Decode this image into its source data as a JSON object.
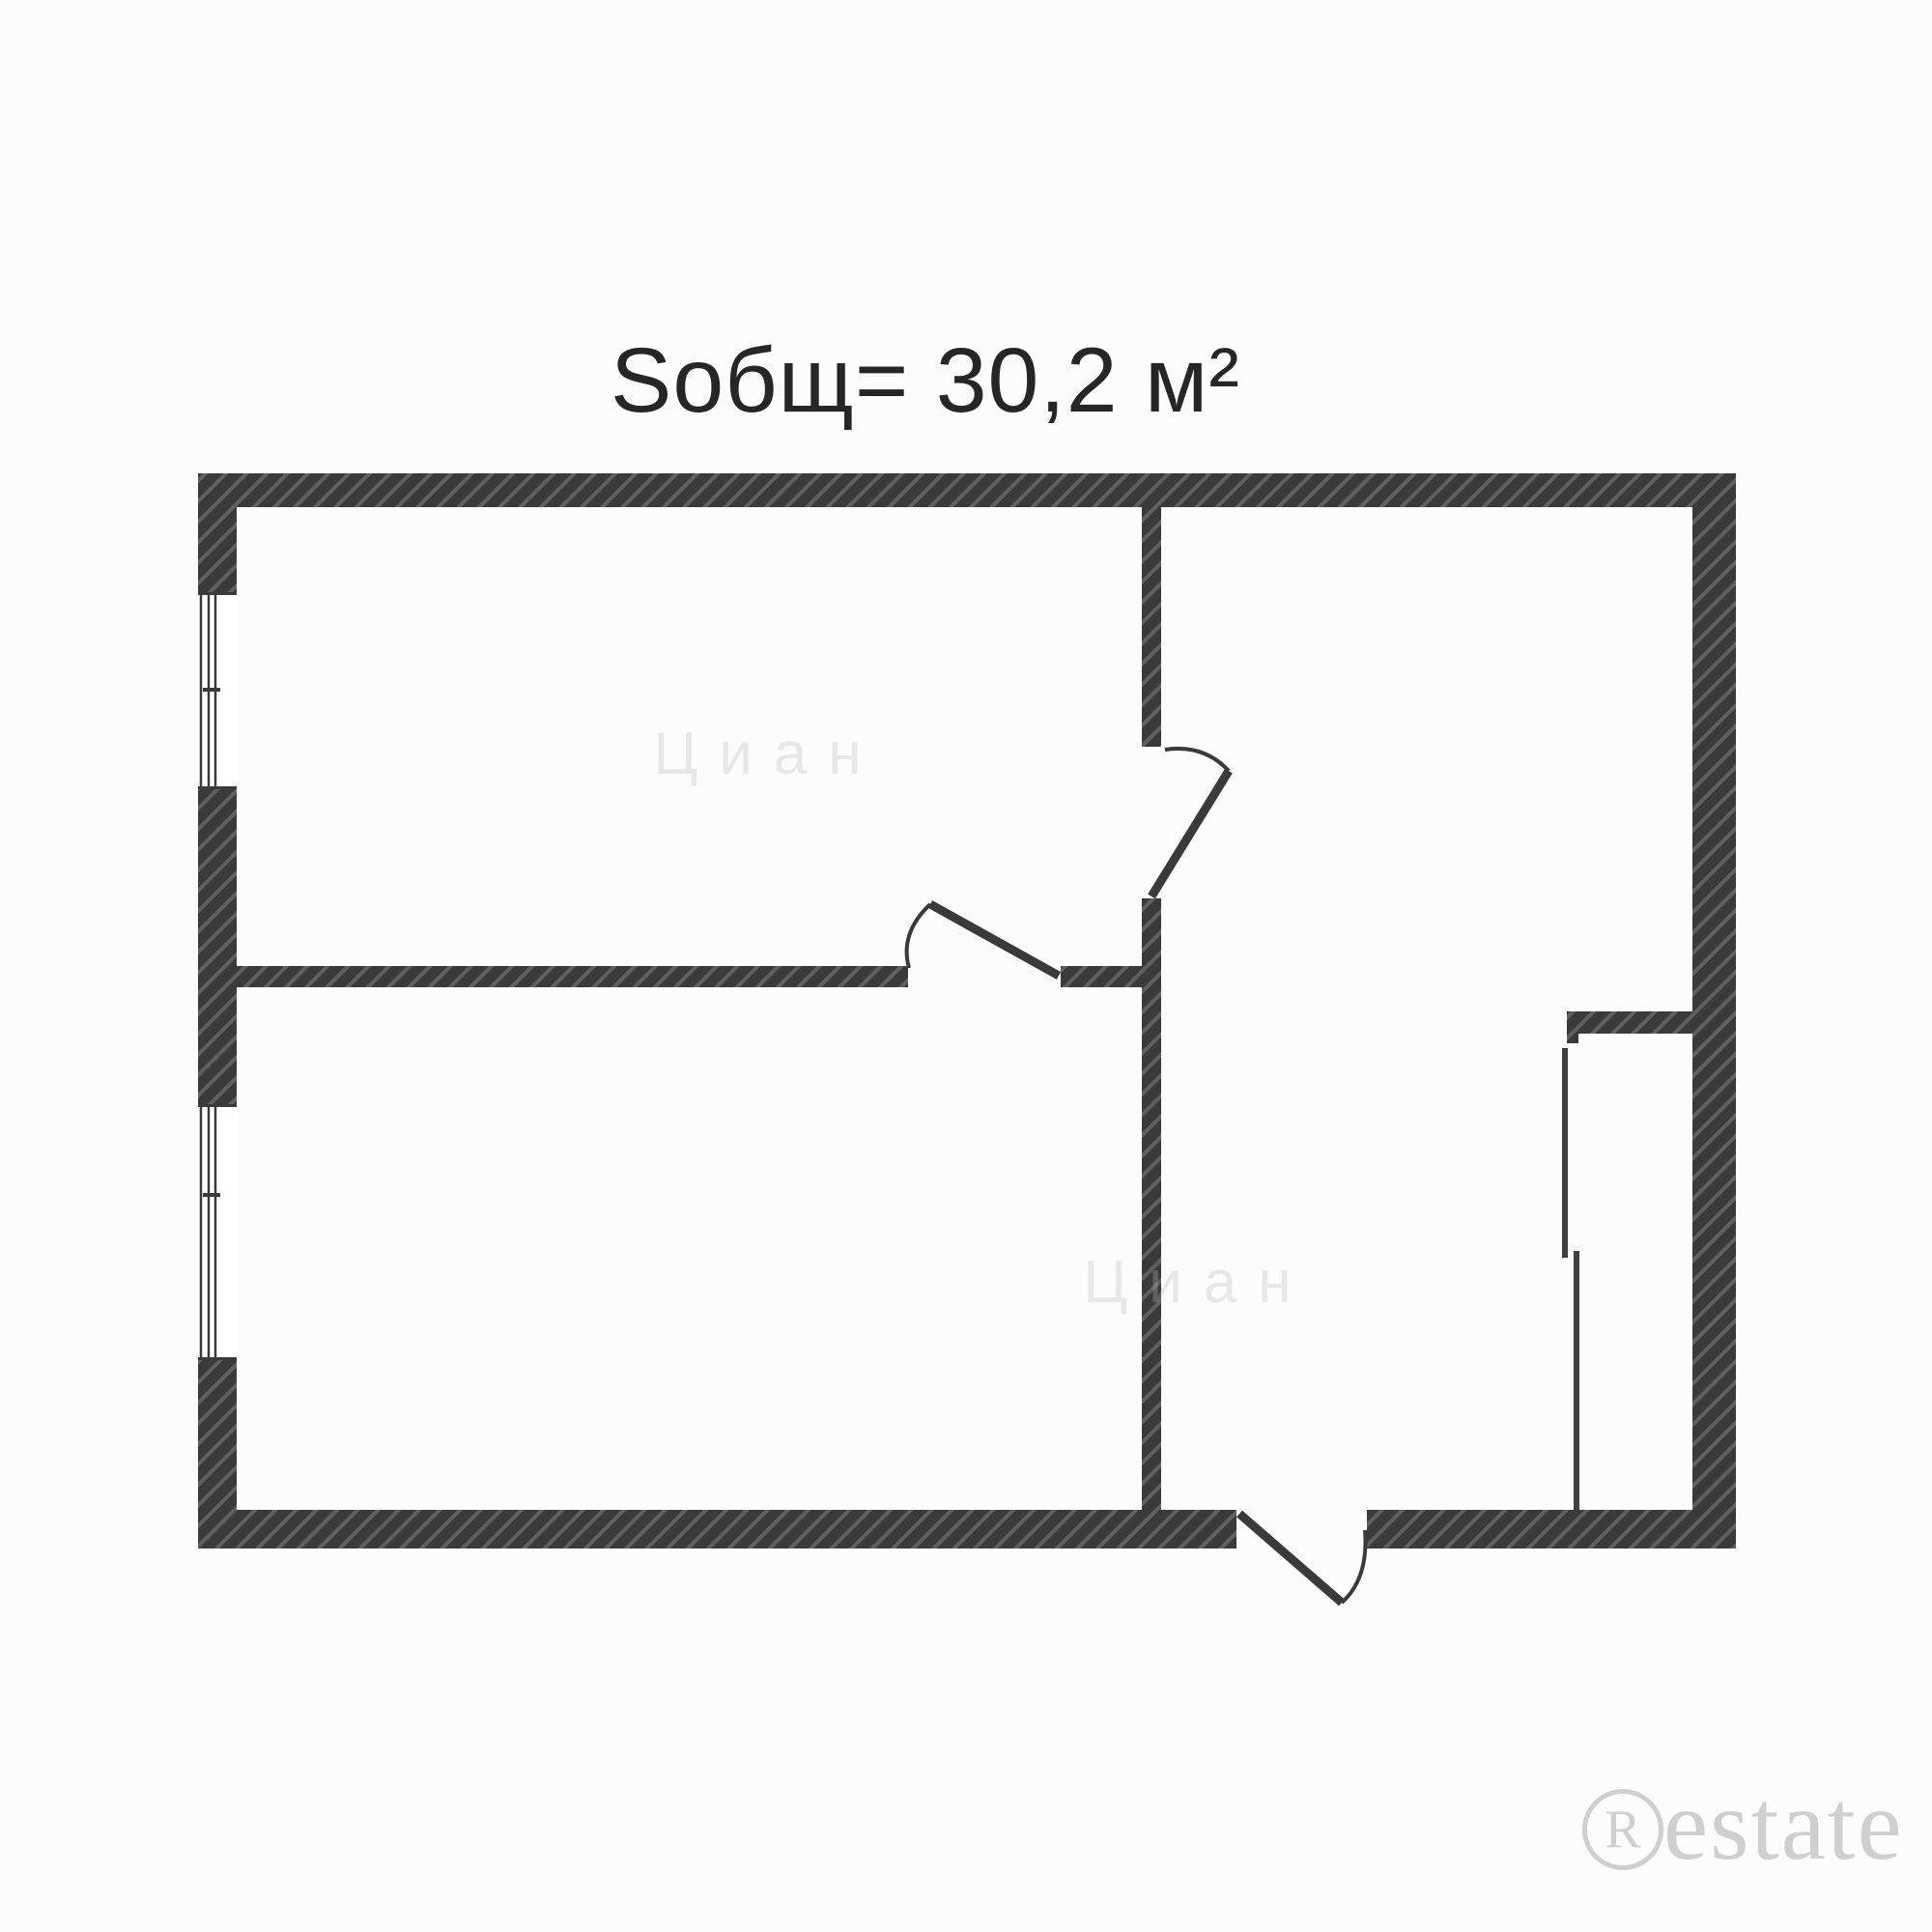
{
  "title": {
    "text": "Sобщ= 30,2 м²"
  },
  "plan": {
    "total_area_label": "Sобщ",
    "total_area_value": "30,2",
    "total_area_unit": "м²",
    "colors": {
      "wall_dark": "#3a3a3a",
      "wall_hatch_light": "#606060",
      "background": "#fcfcfc",
      "interior_white": "#ffffff"
    },
    "elements": {
      "windows": [
        {
          "name": "upper-left-window",
          "wall": "left"
        },
        {
          "name": "lower-left-window",
          "wall": "left"
        }
      ],
      "doors": [
        {
          "name": "interior-door-between-rooms",
          "wall": "horizontal-partition"
        },
        {
          "name": "interior-door-hallway",
          "wall": "vertical-partition"
        },
        {
          "name": "entrance-door",
          "wall": "bottom-outer-wall"
        }
      ],
      "partitions": [
        {
          "name": "closet-stub-wall"
        },
        {
          "name": "closet-thin-partition-upper"
        },
        {
          "name": "closet-thin-partition-lower"
        }
      ]
    }
  },
  "watermarks": {
    "cian": "Циан",
    "restate_r": "R",
    "restate_text": "estate"
  }
}
